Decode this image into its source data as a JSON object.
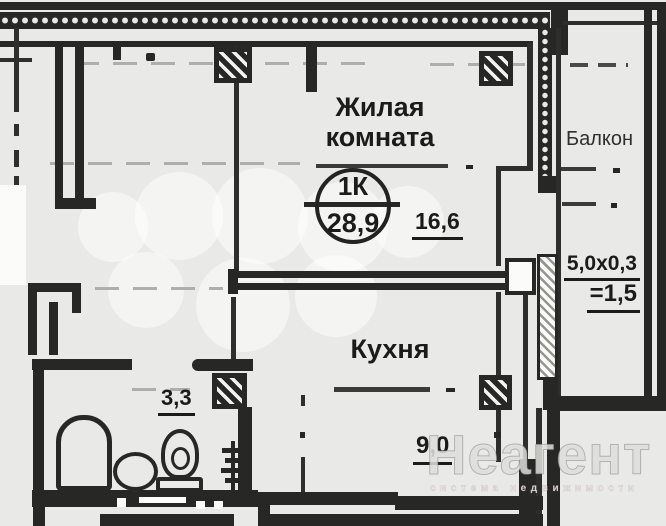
{
  "plan": {
    "stamp": {
      "type": "1К",
      "total_area": "28,9"
    },
    "rooms": {
      "living": {
        "name_line1": "Жилая",
        "name_line2": "комната",
        "area": "16,6"
      },
      "kitchen": {
        "name": "Кухня",
        "area": "9,0"
      },
      "bathroom": {
        "area": "3,3"
      },
      "balcony": {
        "name": "Балкон",
        "dimensions": "5,0х0,3",
        "area": "=1,5"
      }
    }
  },
  "watermark": {
    "brand": "Неагент",
    "tagline": "система недвижимости"
  },
  "colors": {
    "wall": "#272725",
    "paper": "#e9e9e7"
  }
}
